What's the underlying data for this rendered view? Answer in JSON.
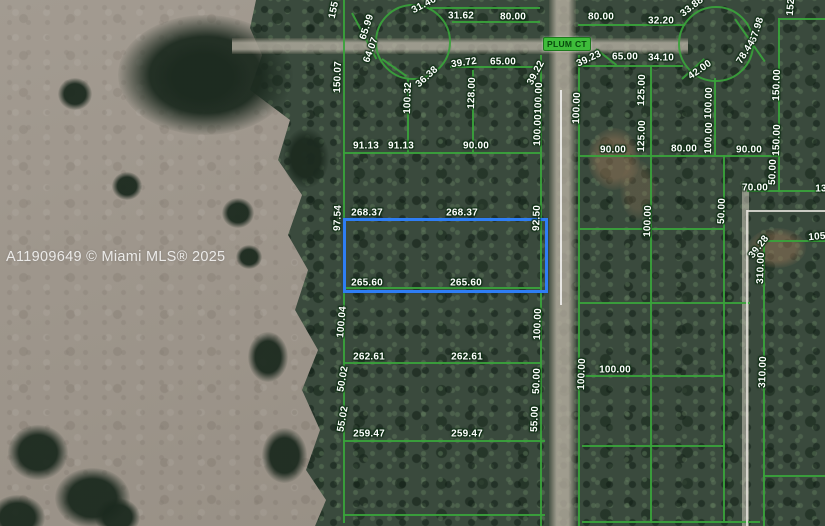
{
  "watermark": "A11909649 © Miami MLS® 2025",
  "street": {
    "label": "PLUM CT"
  },
  "map": {
    "overlay_color": "#3aa33b",
    "highlighted_parcel": {
      "x": 343,
      "y": 218,
      "w": 199,
      "h": 69,
      "color": "#2e7ef5",
      "dimensions": {
        "top": "268.37",
        "bottom": "265.60",
        "left": "97.54",
        "right": "92.50"
      }
    },
    "dimension_labels": [
      {
        "t": "155",
        "x": 334,
        "y": 10,
        "r": -78
      },
      {
        "t": "65.99",
        "x": 367,
        "y": 27,
        "r": -72
      },
      {
        "t": "64.07",
        "x": 371,
        "y": 50,
        "r": -70
      },
      {
        "t": "31.46",
        "x": 424,
        "y": 5,
        "r": -28
      },
      {
        "t": "150.07",
        "x": 338,
        "y": 77,
        "r": -88
      },
      {
        "t": "36.38",
        "x": 427,
        "y": 77,
        "r": -42
      },
      {
        "t": "100.32",
        "x": 408,
        "y": 98,
        "r": -88
      },
      {
        "t": "31.62",
        "x": 461,
        "y": 16,
        "r": 0
      },
      {
        "t": "80.00",
        "x": 513,
        "y": 17,
        "r": 0
      },
      {
        "t": "39.72",
        "x": 464,
        "y": 63,
        "r": -8
      },
      {
        "t": "65.00",
        "x": 503,
        "y": 62,
        "r": 0
      },
      {
        "t": "128.00",
        "x": 472,
        "y": 93,
        "r": -88
      },
      {
        "t": "39.22",
        "x": 536,
        "y": 73,
        "r": -62
      },
      {
        "t": "100.00",
        "x": 539,
        "y": 98,
        "r": -88
      },
      {
        "t": "91.13",
        "x": 366,
        "y": 146,
        "r": 0
      },
      {
        "t": "91.13",
        "x": 401,
        "y": 146,
        "r": 0
      },
      {
        "t": "90.00",
        "x": 476,
        "y": 146,
        "r": 0
      },
      {
        "t": "100.00",
        "x": 538,
        "y": 130,
        "r": -88
      },
      {
        "t": "97.54",
        "x": 338,
        "y": 218,
        "r": -88
      },
      {
        "t": "268.37",
        "x": 367,
        "y": 213,
        "r": 0
      },
      {
        "t": "268.37",
        "x": 462,
        "y": 213,
        "r": 0
      },
      {
        "t": "92.50",
        "x": 537,
        "y": 218,
        "r": -88
      },
      {
        "t": "265.60",
        "x": 367,
        "y": 283,
        "r": 0
      },
      {
        "t": "265.60",
        "x": 466,
        "y": 283,
        "r": 0
      },
      {
        "t": "100.04",
        "x": 342,
        "y": 322,
        "r": -85
      },
      {
        "t": "100.00",
        "x": 538,
        "y": 324,
        "r": -88
      },
      {
        "t": "262.61",
        "x": 369,
        "y": 357,
        "r": 0
      },
      {
        "t": "262.61",
        "x": 467,
        "y": 357,
        "r": 0
      },
      {
        "t": "50.02",
        "x": 343,
        "y": 379,
        "r": -80
      },
      {
        "t": "50.00",
        "x": 537,
        "y": 381,
        "r": -88
      },
      {
        "t": "55.02",
        "x": 343,
        "y": 419,
        "r": -80
      },
      {
        "t": "55.00",
        "x": 535,
        "y": 419,
        "r": -88
      },
      {
        "t": "259.47",
        "x": 369,
        "y": 434,
        "r": 0
      },
      {
        "t": "259.47",
        "x": 467,
        "y": 434,
        "r": 0
      },
      {
        "t": "100.00",
        "x": 577,
        "y": 108,
        "r": -88
      },
      {
        "t": "80.00",
        "x": 601,
        "y": 17,
        "r": 0
      },
      {
        "t": "32.20",
        "x": 661,
        "y": 21,
        "r": 0
      },
      {
        "t": "33.88",
        "x": 692,
        "y": 7,
        "r": -38
      },
      {
        "t": "39.23",
        "x": 589,
        "y": 59,
        "r": -25
      },
      {
        "t": "65.00",
        "x": 625,
        "y": 57,
        "r": 0
      },
      {
        "t": "34.10",
        "x": 661,
        "y": 58,
        "r": 0
      },
      {
        "t": "42.00",
        "x": 700,
        "y": 70,
        "r": -35
      },
      {
        "t": "125.00",
        "x": 642,
        "y": 90,
        "r": -88
      },
      {
        "t": "125.00",
        "x": 642,
        "y": 136,
        "r": -88
      },
      {
        "t": "100.00",
        "x": 709,
        "y": 103,
        "r": -88
      },
      {
        "t": "100.00",
        "x": 709,
        "y": 138,
        "r": -88
      },
      {
        "t": "90.00",
        "x": 613,
        "y": 150,
        "r": 0
      },
      {
        "t": "80.00",
        "x": 684,
        "y": 149,
        "r": 0
      },
      {
        "t": "90.00",
        "x": 749,
        "y": 150,
        "r": 0
      },
      {
        "t": "67.98",
        "x": 757,
        "y": 30,
        "r": -72
      },
      {
        "t": "78.44",
        "x": 746,
        "y": 52,
        "r": -58
      },
      {
        "t": "152",
        "x": 791,
        "y": 7,
        "r": -85
      },
      {
        "t": "150.00",
        "x": 777,
        "y": 85,
        "r": -88
      },
      {
        "t": "150.00",
        "x": 777,
        "y": 140,
        "r": -88
      },
      {
        "t": "50.00",
        "x": 773,
        "y": 172,
        "r": -88
      },
      {
        "t": "70.00",
        "x": 755,
        "y": 188,
        "r": 0
      },
      {
        "t": "13",
        "x": 821,
        "y": 189,
        "r": 0
      },
      {
        "t": "50.00",
        "x": 722,
        "y": 211,
        "r": -88
      },
      {
        "t": "100.00",
        "x": 648,
        "y": 221,
        "r": -88
      },
      {
        "t": "105",
        "x": 817,
        "y": 237,
        "r": -5
      },
      {
        "t": "39.28",
        "x": 759,
        "y": 247,
        "r": -52
      },
      {
        "t": "310.00",
        "x": 761,
        "y": 268,
        "r": -88
      },
      {
        "t": "310.00",
        "x": 763,
        "y": 372,
        "r": -88
      },
      {
        "t": "100.00",
        "x": 582,
        "y": 374,
        "r": -88
      },
      {
        "t": "100.00",
        "x": 615,
        "y": 370,
        "r": 0
      }
    ],
    "parcel_lines": [
      {
        "o": "v",
        "x": 343,
        "y": 0,
        "len": 523
      },
      {
        "o": "v",
        "x": 540,
        "y": 55,
        "len": 471
      },
      {
        "o": "v",
        "x": 578,
        "y": 55,
        "len": 471
      },
      {
        "o": "v",
        "x": 650,
        "y": 66,
        "len": 455
      },
      {
        "o": "v",
        "x": 723,
        "y": 155,
        "len": 366
      },
      {
        "o": "v",
        "x": 778,
        "y": 18,
        "len": 174
      },
      {
        "o": "v",
        "x": 763,
        "y": 240,
        "len": 286
      },
      {
        "o": "v",
        "x": 407,
        "y": 78,
        "len": 74
      },
      {
        "o": "v",
        "x": 472,
        "y": 70,
        "len": 82
      },
      {
        "o": "v",
        "x": 714,
        "y": 78,
        "len": 77
      },
      {
        "o": "h",
        "x": 430,
        "y": 7,
        "len": 110
      },
      {
        "o": "h",
        "x": 452,
        "y": 21,
        "len": 88
      },
      {
        "o": "h",
        "x": 343,
        "y": 152,
        "len": 197
      },
      {
        "o": "h",
        "x": 343,
        "y": 218,
        "len": 197
      },
      {
        "o": "h",
        "x": 343,
        "y": 287,
        "len": 197
      },
      {
        "o": "h",
        "x": 343,
        "y": 362,
        "len": 197
      },
      {
        "o": "h",
        "x": 343,
        "y": 440,
        "len": 202
      },
      {
        "o": "h",
        "x": 343,
        "y": 514,
        "len": 202
      },
      {
        "o": "h",
        "x": 450,
        "y": 66,
        "len": 90
      },
      {
        "o": "h",
        "x": 578,
        "y": 24,
        "len": 107
      },
      {
        "o": "h",
        "x": 578,
        "y": 65,
        "len": 105
      },
      {
        "o": "h",
        "x": 578,
        "y": 155,
        "len": 200
      },
      {
        "o": "h",
        "x": 747,
        "y": 190,
        "len": 78
      },
      {
        "o": "h",
        "x": 578,
        "y": 228,
        "len": 145
      },
      {
        "o": "h",
        "x": 763,
        "y": 240,
        "len": 62
      },
      {
        "o": "h",
        "x": 578,
        "y": 302,
        "len": 172
      },
      {
        "o": "h",
        "x": 578,
        "y": 375,
        "len": 147
      },
      {
        "o": "h",
        "x": 582,
        "y": 445,
        "len": 143
      },
      {
        "o": "h",
        "x": 763,
        "y": 475,
        "len": 62
      },
      {
        "o": "h",
        "x": 582,
        "y": 521,
        "len": 178
      },
      {
        "o": "h",
        "x": 778,
        "y": 18,
        "len": 47
      }
    ],
    "diagonal_stubs": [
      {
        "x": 352,
        "y": 12,
        "len": 52,
        "r": 62
      },
      {
        "x": 382,
        "y": 58,
        "len": 30,
        "r": 35
      },
      {
        "x": 735,
        "y": 18,
        "len": 52,
        "r": 55
      },
      {
        "x": 682,
        "y": 78,
        "len": 30,
        "r": -42
      },
      {
        "x": 596,
        "y": 48,
        "len": 26,
        "r": 38
      }
    ],
    "cul_de_sacs": [
      {
        "cx": 411,
        "cy": 40,
        "r": 36
      },
      {
        "cx": 714,
        "cy": 42,
        "r": 36
      }
    ],
    "boundary_lines": [
      {
        "o": "h",
        "x": 747,
        "y": 210,
        "len": 78
      },
      {
        "o": "v",
        "x": 746,
        "y": 210,
        "len": 316
      }
    ]
  }
}
